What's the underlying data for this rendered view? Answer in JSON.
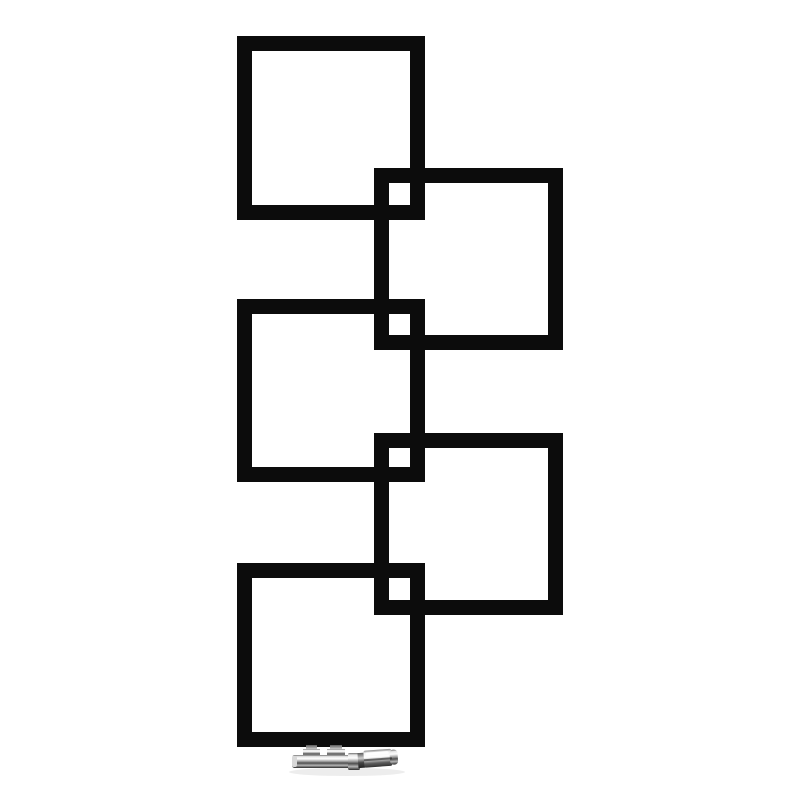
{
  "image": {
    "kind": "product-photo",
    "subject": "designer radiator of five interlocking squares with chrome valve",
    "background_color": "#ffffff",
    "foreground_color": "#0c0c0c"
  },
  "radiator": {
    "stroke_width": 15,
    "squares": [
      {
        "name": "top-left",
        "x": 237,
        "y": 36,
        "w": 188,
        "h": 184
      },
      {
        "name": "top-right",
        "x": 374,
        "y": 168,
        "w": 189,
        "h": 182
      },
      {
        "name": "middle-left",
        "x": 237,
        "y": 299,
        "w": 188,
        "h": 183
      },
      {
        "name": "middle-right",
        "x": 374,
        "y": 433,
        "w": 189,
        "h": 182
      },
      {
        "name": "bottom-left",
        "x": 237,
        "y": 563,
        "w": 188,
        "h": 184
      }
    ]
  },
  "valve": {
    "x": 292,
    "y": 742,
    "finish": "chrome",
    "colors": {
      "highlight": "#fdfdfd",
      "mid": "#9b9b9b",
      "shadow": "#2a2a2a"
    }
  }
}
